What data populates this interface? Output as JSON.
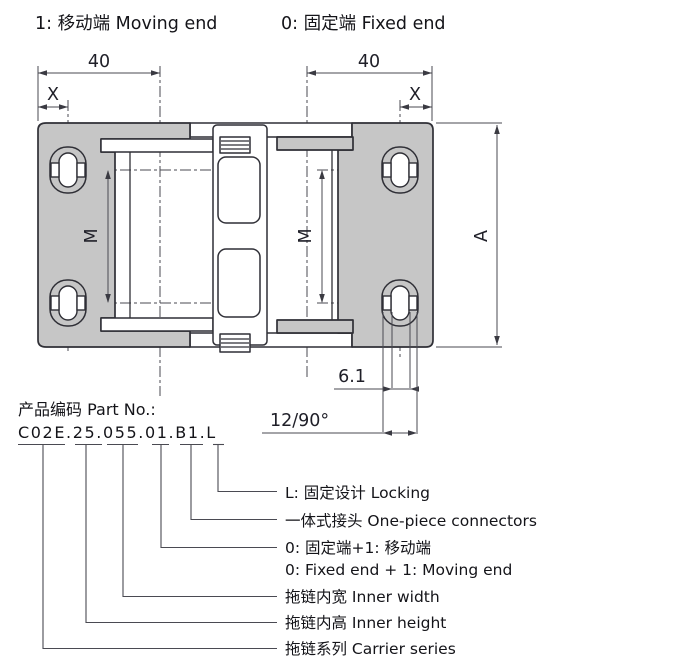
{
  "page": {
    "background": "#ffffff"
  },
  "header": {
    "moving_end_label": "1: 移动端 Moving end",
    "fixed_end_label": "0: 固定端 Fixed end"
  },
  "drawing": {
    "type": "engineering-top-view",
    "description": "Cable drag-chain (carrier) end mounting brackets, top view with dimensions",
    "colors": {
      "plate_fill": "#c6c6c6",
      "outline": "#2f2f36",
      "dimension_line": "#4a4a52",
      "text": "#1f1f28"
    },
    "dimensions": {
      "top_width_left": "40",
      "top_width_right": "40",
      "edge_offset_left": "X",
      "edge_offset_right": "X",
      "hole_spacing_left": "M",
      "hole_spacing_right": "M",
      "overall_length": "A",
      "slot_width": "6.1",
      "pitch_angle": "12/90°"
    }
  },
  "part_number": {
    "label": "产品编码 Part No.:",
    "code": "C02E.25.055.01.B1.L",
    "segments": [
      {
        "code": "C02E",
        "meaning_zh": "拖链系列",
        "meaning_en": "Carrier series"
      },
      {
        "code": "25",
        "meaning_zh": "拖链内高",
        "meaning_en": "Inner height"
      },
      {
        "code": "055",
        "meaning_zh": "拖链内宽",
        "meaning_en": "Inner width"
      },
      {
        "code": "01",
        "meaning_zh": "0: 固定端+1: 移动端",
        "meaning_en": "0: Fixed end + 1: Moving end"
      },
      {
        "code": "B1",
        "meaning_zh": "一体式接头",
        "meaning_en": "One-piece connectors"
      },
      {
        "code": "L",
        "meaning_zh": "L: 固定设计",
        "meaning_en": "Locking"
      }
    ]
  },
  "callouts": [
    {
      "line1": "L: 固定设计 Locking"
    },
    {
      "line1": "一体式接头 One-piece connectors"
    },
    {
      "line1": "0: 固定端+1: 移动端",
      "line2": "0: Fixed end + 1: Moving end"
    },
    {
      "line1": "拖链内宽 Inner width"
    },
    {
      "line1": "拖链内高 Inner height"
    },
    {
      "line1": "拖链系列 Carrier series"
    }
  ]
}
